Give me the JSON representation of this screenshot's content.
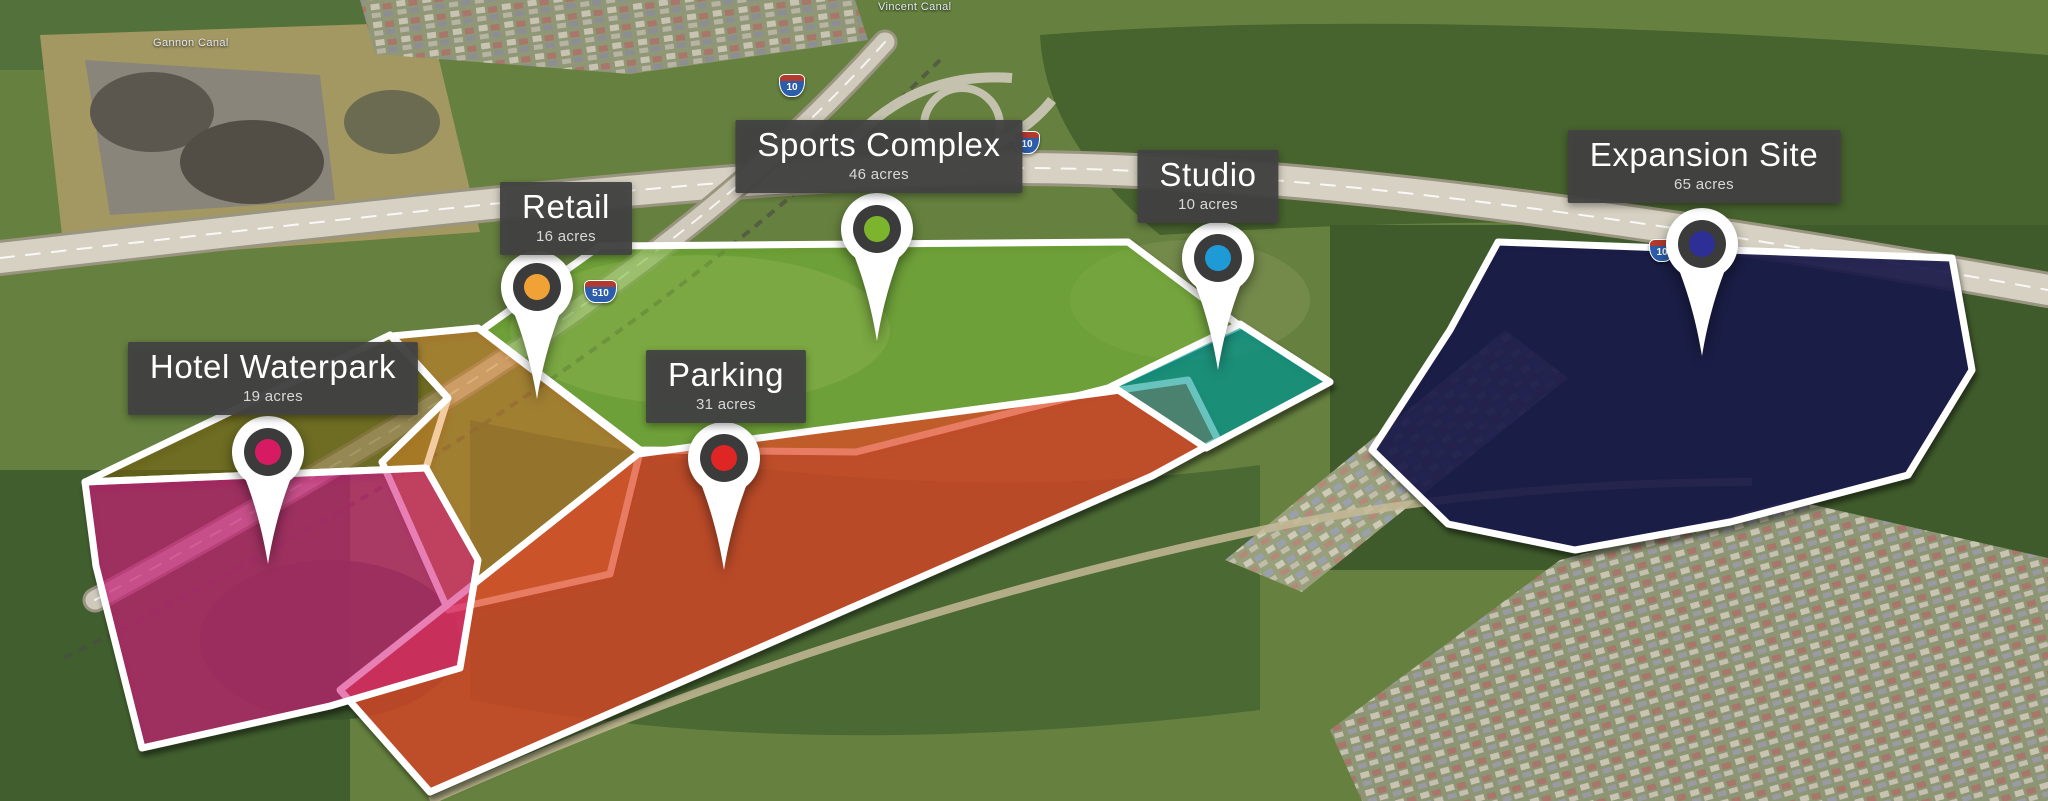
{
  "map_labels": {
    "canal_top": "Vincent Canal",
    "canal_left": "Gannon Canal"
  },
  "shields": [
    {
      "route": "10"
    },
    {
      "route": "10"
    },
    {
      "route": "510"
    },
    {
      "route": "10"
    }
  ],
  "parcels": [
    {
      "name": "Hotel Waterpark",
      "acres": "19 acres",
      "marker_color": "#d61b62",
      "fill": "rgba(213,33,126,0.58)"
    },
    {
      "name": "Retail",
      "acres": "16 acres",
      "marker_color": "#f0a236",
      "fill": "rgba(227,140,44,0.45)"
    },
    {
      "name": "Parking",
      "acres": "31 acres",
      "marker_color": "#e02525",
      "fill": "rgba(222,74,40,0.72)"
    },
    {
      "name": "Sports Complex",
      "acres": "46 acres",
      "marker_color": "#7cb42e",
      "fill": "rgba(130,204,58,0.45)"
    },
    {
      "name": "Studio",
      "acres": "10 acres",
      "marker_color": "#1e9bd7",
      "fill": "rgba(10,158,150,0.62)"
    },
    {
      "name": "Expansion Site",
      "acres": "65 acres",
      "marker_color": "#2d2f97",
      "fill": "rgba(24,25,74,0.85)"
    }
  ],
  "regions": {
    "pond_tint": "rgba(128,108,16,0.5)"
  }
}
